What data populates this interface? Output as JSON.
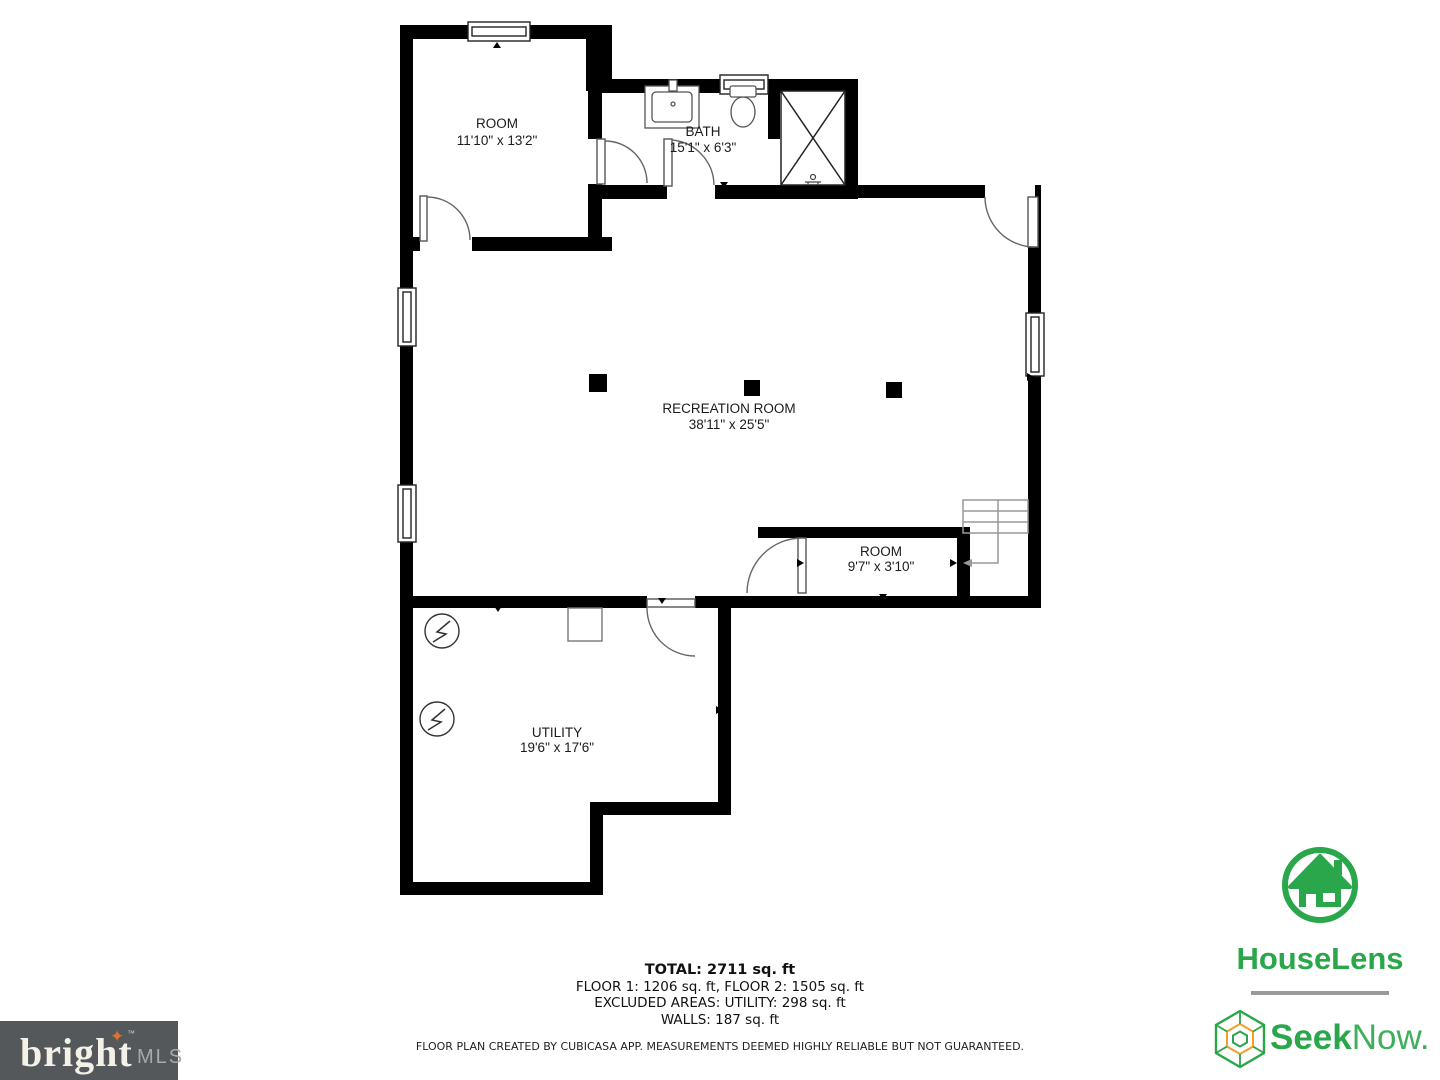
{
  "floorplan": {
    "rooms": [
      {
        "id": "bedroom",
        "name": "ROOM",
        "dims": "11'10\" x 13'2\""
      },
      {
        "id": "bath",
        "name": "BATH",
        "dims": "15'1\" x 6'3\""
      },
      {
        "id": "recreation",
        "name": "RECREATION ROOM",
        "dims": "38'11\" x 25'5\""
      },
      {
        "id": "small-room",
        "name": "ROOM",
        "dims": "9'7\" x 3'10\""
      },
      {
        "id": "utility",
        "name": "UTILITY",
        "dims": "19'6\" x 17'6\""
      }
    ],
    "summary": {
      "total": "TOTAL: 2711 sq. ft",
      "floors": "FLOOR 1: 1206 sq. ft, FLOOR 2: 1505 sq. ft",
      "excluded": "EXCLUDED AREAS: UTILITY: 298 sq. ft",
      "walls": "WALLS: 187 sq. ft",
      "disclaimer": "FLOOR PLAN CREATED BY CUBICASA APP. MEASUREMENTS DEEMED HIGHLY RELIABLE BUT NOT GUARANTEED."
    }
  },
  "branding": {
    "houselens": {
      "name": "HouseLens",
      "color": "#2aa64b"
    },
    "seeknow": {
      "bold": "Seek",
      "regular": "Now.",
      "green": "#2aa64b",
      "orange": "#f0a028"
    },
    "brightmls": {
      "word": "bright",
      "tm": "™",
      "suffix": "MLS",
      "sparkle": "✦",
      "bg": "#54585b",
      "accent": "#e2702a"
    }
  }
}
